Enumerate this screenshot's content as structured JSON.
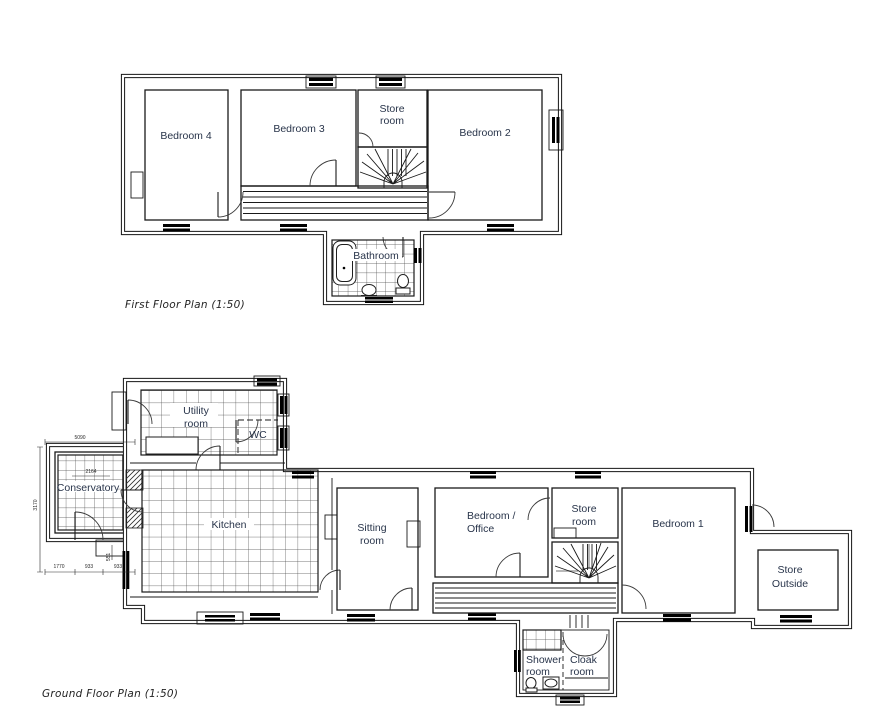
{
  "document": {
    "background": "#ffffff",
    "wall_color": "#141414",
    "label_color": "#28344a"
  },
  "first_floor": {
    "title": "First  Floor Plan (1:50)",
    "rooms": {
      "bedroom4": {
        "label": "Bedroom 4"
      },
      "bedroom3": {
        "label": "Bedroom 3"
      },
      "store_room": {
        "line1": "Store",
        "line2": "room"
      },
      "bedroom2": {
        "label": "Bedroom 2"
      },
      "bathroom": {
        "label": "Bathroom"
      }
    }
  },
  "ground_floor": {
    "title": "Ground Floor Plan (1:50)",
    "rooms": {
      "utility_room": {
        "line1": "Utility",
        "line2": "room"
      },
      "wc": {
        "label": "WC"
      },
      "conservatory": {
        "label": "Conservatory"
      },
      "kitchen": {
        "label": "Kitchen"
      },
      "sitting_room": {
        "line1": "Sitting",
        "line2": "room"
      },
      "bedroom_office": {
        "line1": "Bedroom /",
        "line2": "Office"
      },
      "store_room": {
        "line1": "Store",
        "line2": "room"
      },
      "bedroom1": {
        "label": "Bedroom 1"
      },
      "store_outside": {
        "line1": "Store",
        "line2": "Outside"
      },
      "shower_room": {
        "line1": "Shower",
        "line2": "room"
      },
      "cloak_room": {
        "line1": "Cloak",
        "line2": "room"
      }
    },
    "dimensions": {
      "conservatory_width": "5090",
      "conservatory_height": "3170",
      "inner_width": "2164",
      "step_depth": "551",
      "bottom_segments": [
        "1770",
        "933",
        "933"
      ]
    }
  }
}
